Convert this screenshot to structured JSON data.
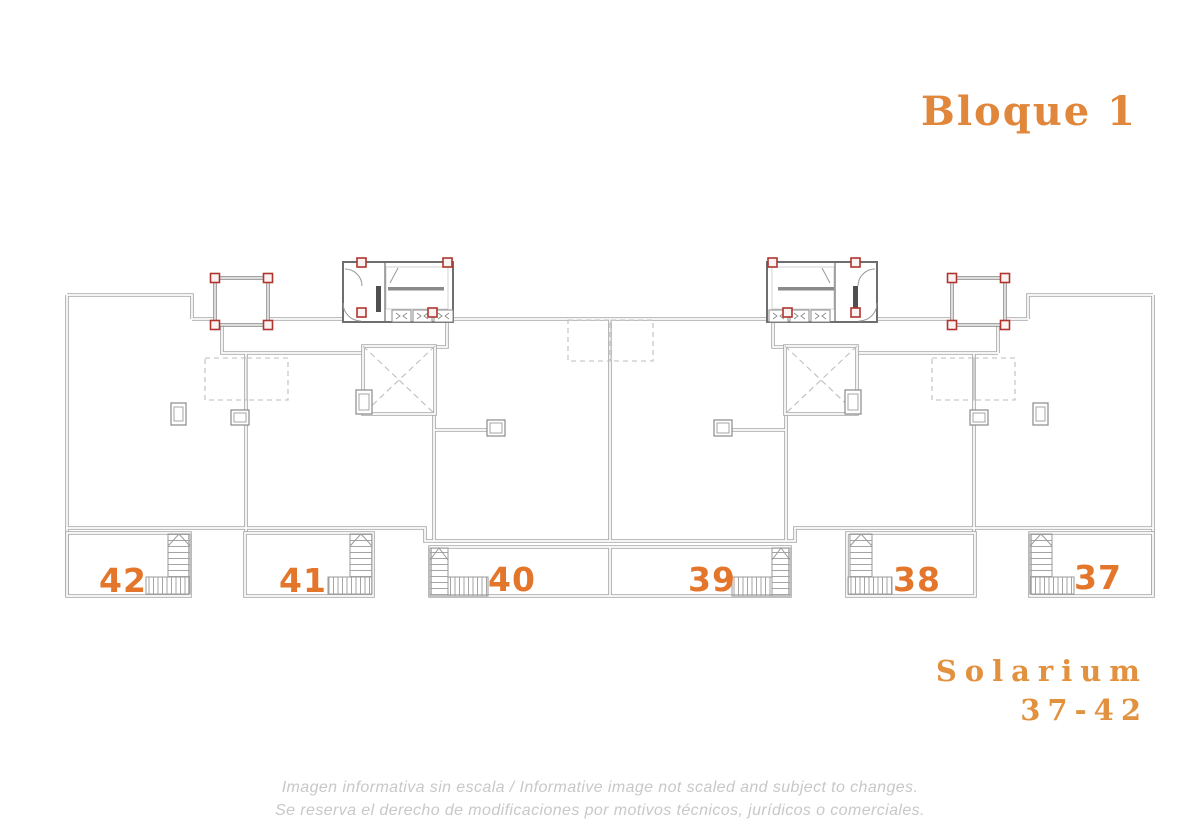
{
  "header": {
    "block_title": "Bloque 1"
  },
  "plan": {
    "name": "Bloque 1 solarium level floor plan",
    "units": [
      {
        "label": "42"
      },
      {
        "label": "41"
      },
      {
        "label": "40"
      },
      {
        "label": "39"
      },
      {
        "label": "38"
      },
      {
        "label": "37"
      }
    ]
  },
  "footer": {
    "solarium_label": "Solarium",
    "solarium_range": "37-42",
    "disclaimer_line1": "Imagen informativa sin escala /  Informative image not scaled and subject to changes.",
    "disclaimer_line2": "Se reserva el derecho de modificaciones por motivos técnicos, jurídicos o comerciales."
  },
  "colors": {
    "accent_orange": "#E1873C",
    "unit_number_orange": "#E3762B",
    "column_red": "#B0352F",
    "wall_gray": "#A8A8A8",
    "dark_wall_gray": "#6E6E6E",
    "disclaimer_gray": "#C8C8C8"
  }
}
